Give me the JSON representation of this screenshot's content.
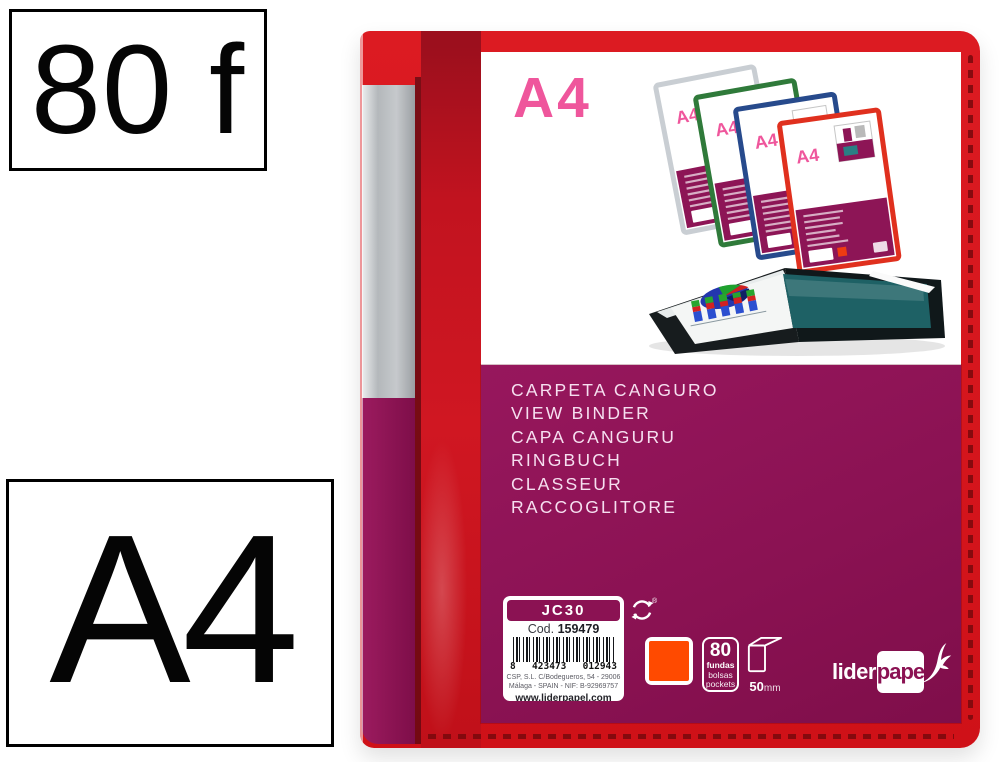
{
  "badges": {
    "sheets_label": "80 f",
    "format_label": "A4"
  },
  "binder": {
    "cover": {
      "format_label": "A4"
    },
    "languages": [
      "CARPETA CANGURO",
      "VIEW BINDER",
      "CAPA CANGURU",
      "RINGBUCH",
      "CLASSEUR",
      "RACCOGLITORE"
    ],
    "label": {
      "model": "JC30",
      "code_prefix": "Cod.",
      "code_number": "159479",
      "barcode_d1": "8",
      "barcode_d2": "423473",
      "barcode_d3": "012943",
      "address_line1": "CSP, S.L. C/Bodegueros, 54 - 29006",
      "address_line2": "Málaga - SPAIN - NIF: B-92969757",
      "website": "www.liderpapel.com",
      "registered_mark": "®"
    },
    "specs": {
      "pockets_count": "80",
      "pockets_es": "fundas",
      "pockets_pt": "bolsas",
      "pockets_en": "pockets",
      "spine_value": "50",
      "spine_unit": "mm"
    },
    "brand": {
      "part1": "lider",
      "part2": "pape"
    },
    "photo": {
      "mini_format_label": "A4"
    },
    "colors": {
      "maroon": "#8B1253",
      "red": "#D6151C",
      "crimson": "#C2131F",
      "pink": "#EF569C",
      "orange": "#FF4A00",
      "silver": "#BABDC0"
    }
  }
}
